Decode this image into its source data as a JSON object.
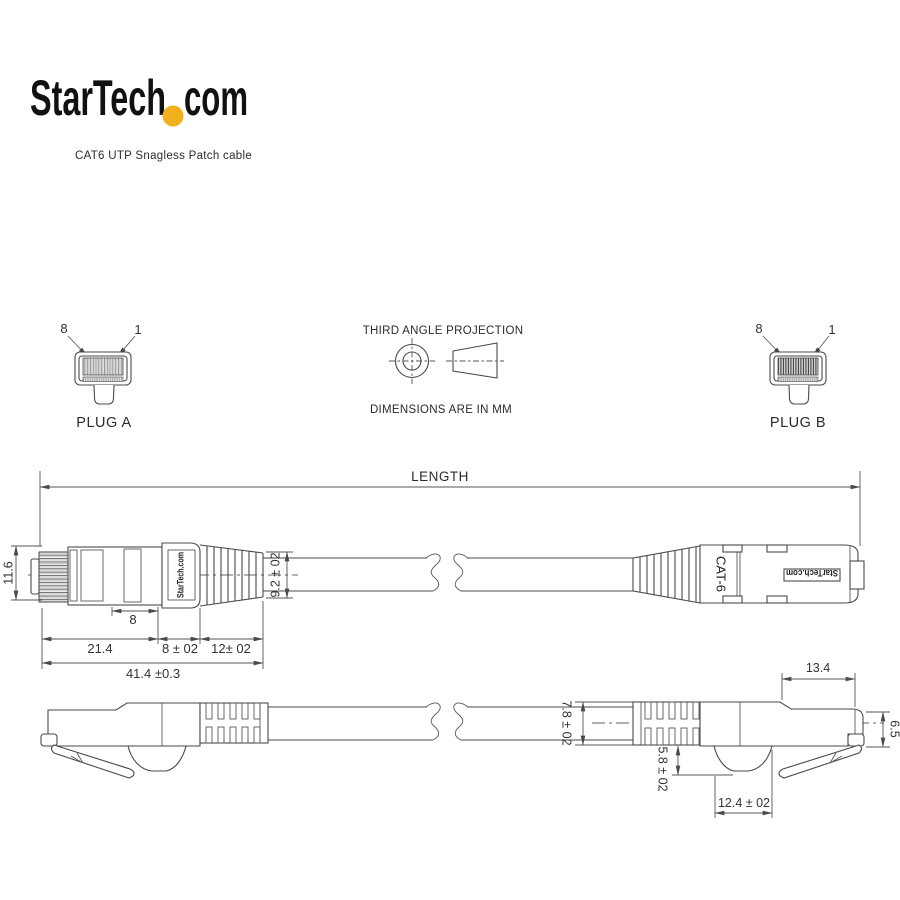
{
  "brand": {
    "left": "StarTech",
    "right": "com"
  },
  "subtitle": "CAT6 UTP Snagless Patch cable",
  "projection": {
    "title": "THIRD ANGLE PROJECTION",
    "note": "DIMENSIONS ARE IN MM"
  },
  "plug_a": {
    "label": "PLUG A",
    "pin_left": "8",
    "pin_right": "1"
  },
  "plug_b": {
    "label": "PLUG B",
    "pin_left": "8",
    "pin_right": "1"
  },
  "side_view": {
    "length_label": "LENGTH",
    "boot_brand": "StarTech.com",
    "body_brand": "StarTech.com",
    "cable_marking": "CAT-6",
    "dim_height": "11.6",
    "dim_latch": "8",
    "dim_body": "21.4",
    "dim_boot": "8 ± 02",
    "dim_relief": "12± 02",
    "dim_total": "41.4 ±0.3",
    "dim_boot_dia": "9.2 ± 02"
  },
  "bottom_view": {
    "dim_relief_od": "7.8 ± 02",
    "dim_latch_depth": "5.8 ± 02",
    "dim_guard_len": "12.4 ± 02",
    "dim_tip_len": "13.4",
    "dim_tip_height": "6.5"
  },
  "colors": {
    "accent_dot": "#f2b01e",
    "line": "#4a4a4a"
  }
}
